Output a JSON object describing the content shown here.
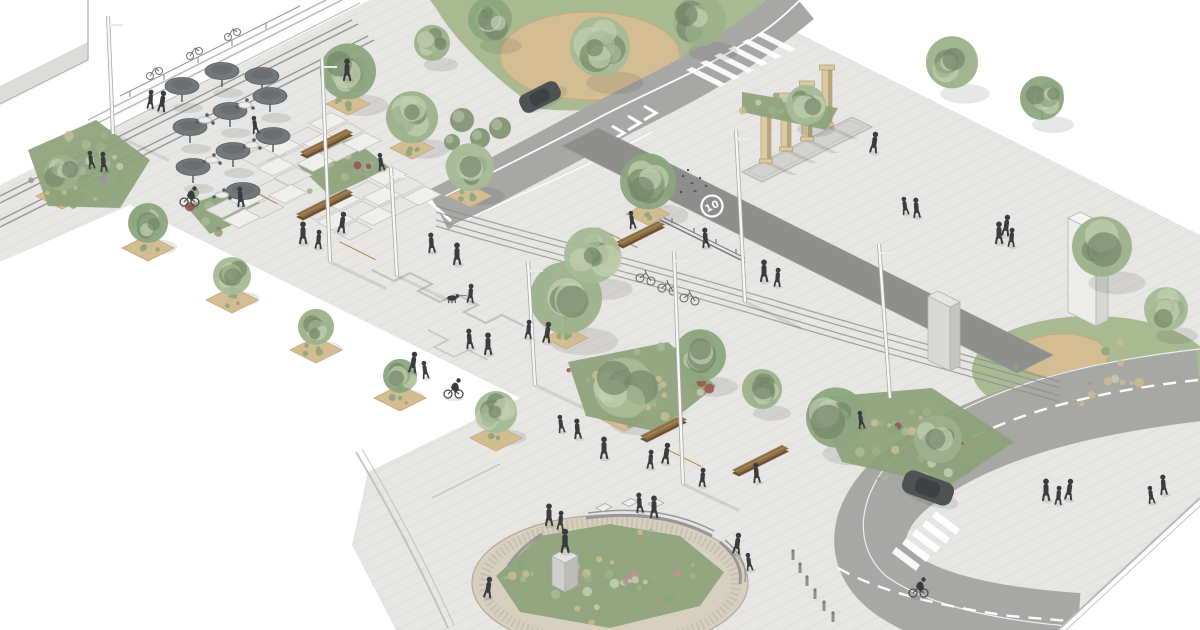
{
  "scene": {
    "road_marking": {
      "label": "10"
    },
    "colors": {
      "bg": "#ffffff",
      "plaza": "#e7e6e4",
      "paver_line": "#d6d6d4",
      "road": "#a7a7a5",
      "road_dark": "#8e8e8c",
      "band_edge": "#9a9a98",
      "marking": "#ffffff",
      "lawn": "#a9ba92",
      "sand": "#d4bd93",
      "sand_edge": "#c4ab7e",
      "cobble": "#d7d0c0",
      "cobble_edge": "#b2ab99",
      "cobble_dot": "#bdb7a7",
      "bed_base": "#8da27a",
      "wood": "#8f6f46",
      "wood_light": "#aa8957",
      "wood_dark": "#6c5234",
      "umbrella": "#75787a",
      "umbrella_dark": "#5c5f61",
      "people": "#3a3c3d",
      "trunk": "#8b8274",
      "pole": "#f7f7f5",
      "pole_edge": "#a9a9a7",
      "column": "#d9caa0",
      "column_dark": "#b7a67d",
      "monolith": "#ededeb",
      "monolith_side": "#d5d5d3",
      "concrete": "#d8d8d6",
      "concrete_side": "#c3c3c1",
      "car": "#4e5253",
      "car_roof": "#3b3f40",
      "rail": "#8d8d8b",
      "line_gray": "#b9b9b7",
      "bush": "#7d9070",
      "red_accent": "#98524d",
      "pink_accent": "#c38f92",
      "lavender": "#9a90b4",
      "tan_grass": "#c8bd92",
      "tree_greens": [
        "#9cb18b",
        "#8ca57e",
        "#a6ba96"
      ],
      "tree_light": "#c3cfb0",
      "tree_dark": "#75886a",
      "shadow": "rgba(60,60,58,0.12)"
    },
    "trees": [
      [
        62,
        190,
        18,
        0
      ],
      [
        148,
        242,
        20,
        1
      ],
      [
        232,
        294,
        19,
        2
      ],
      [
        316,
        344,
        18,
        0
      ],
      [
        400,
        392,
        17,
        1
      ],
      [
        496,
        432,
        21,
        2
      ],
      [
        348,
        98,
        28,
        1
      ],
      [
        412,
        142,
        26,
        0
      ],
      [
        470,
        190,
        24,
        2
      ],
      [
        432,
        60,
        18,
        0
      ],
      [
        566,
        332,
        36,
        0
      ],
      [
        592,
        282,
        28,
        2
      ],
      [
        648,
        208,
        28,
        1
      ],
      [
        600,
        75,
        30,
        2
      ],
      [
        700,
        45,
        26,
        0
      ],
      [
        490,
        40,
        22,
        1
      ],
      [
        952,
        87,
        26,
        0
      ],
      [
        1042,
        119,
        22,
        1
      ],
      [
        806,
        124,
        20,
        2
      ],
      [
        1102,
        275,
        30,
        0
      ],
      [
        1166,
        330,
        22,
        2
      ],
      [
        836,
        446,
        30,
        1
      ],
      [
        938,
        462,
        24,
        0
      ],
      [
        624,
        416,
        30,
        2
      ],
      [
        700,
        380,
        26,
        1
      ],
      [
        762,
        408,
        20,
        0
      ]
    ],
    "tree_pits": [
      [
        348,
        104,
        44
      ],
      [
        412,
        148,
        44
      ],
      [
        470,
        196,
        44
      ],
      [
        566,
        338,
        44
      ],
      [
        648,
        214,
        44
      ],
      [
        624,
        420,
        44
      ],
      [
        62,
        196,
        52
      ],
      [
        148,
        248,
        52
      ],
      [
        232,
        300,
        52
      ],
      [
        316,
        350,
        52
      ],
      [
        400,
        398,
        52
      ],
      [
        496,
        438,
        52
      ]
    ],
    "people": [
      [
        92,
        168
      ],
      [
        104,
        171
      ],
      [
        347,
        80
      ],
      [
        150,
        108
      ],
      [
        161,
        111
      ],
      [
        256,
        133
      ],
      [
        241,
        206
      ],
      [
        303,
        243
      ],
      [
        318,
        248
      ],
      [
        341,
        232
      ],
      [
        382,
        170
      ],
      [
        432,
        252
      ],
      [
        457,
        264
      ],
      [
        470,
        302
      ],
      [
        412,
        372
      ],
      [
        426,
        378
      ],
      [
        470,
        348
      ],
      [
        488,
        354
      ],
      [
        528,
        338
      ],
      [
        546,
        342
      ],
      [
        562,
        432
      ],
      [
        578,
        438
      ],
      [
        604,
        458
      ],
      [
        650,
        468
      ],
      [
        665,
        463
      ],
      [
        633,
        228
      ],
      [
        706,
        247
      ],
      [
        764,
        281
      ],
      [
        777,
        286
      ],
      [
        873,
        152
      ],
      [
        906,
        214
      ],
      [
        917,
        217
      ],
      [
        999,
        243
      ],
      [
        1011,
        246
      ],
      [
        1005,
        235
      ],
      [
        862,
        428
      ],
      [
        757,
        482
      ],
      [
        1046,
        500
      ],
      [
        1058,
        504
      ],
      [
        1068,
        499
      ],
      [
        1152,
        503
      ],
      [
        1164,
        494
      ],
      [
        549,
        525
      ],
      [
        560,
        529
      ],
      [
        736,
        553
      ],
      [
        750,
        570
      ],
      [
        640,
        512
      ],
      [
        654,
        517
      ],
      [
        702,
        486
      ],
      [
        487,
        597
      ]
    ],
    "cyclists": [
      [
        184,
        206
      ],
      [
        448,
        398
      ],
      [
        913,
        597
      ]
    ],
    "parked_bikes": [
      [
        640,
        278
      ],
      [
        662,
        288
      ],
      [
        684,
        298
      ]
    ],
    "umbrellas": [
      [
        182,
        102
      ],
      [
        222,
        87
      ],
      [
        262,
        92
      ],
      [
        190,
        143
      ],
      [
        230,
        127
      ],
      [
        270,
        112
      ],
      [
        193,
        183
      ],
      [
        233,
        167
      ],
      [
        273,
        152
      ],
      [
        243,
        207
      ]
    ],
    "cafe_tables": [
      [
        205,
        120
      ],
      [
        245,
        105
      ],
      [
        212,
        160
      ],
      [
        252,
        145
      ],
      [
        222,
        195
      ]
    ],
    "poles": [
      [
        330,
        262,
        322,
        58
      ],
      [
        535,
        385,
        528,
        262
      ],
      [
        683,
        484,
        674,
        252
      ],
      [
        890,
        398,
        879,
        244
      ],
      [
        745,
        302,
        736,
        130
      ],
      [
        113,
        134,
        108,
        16
      ],
      [
        397,
        276,
        391,
        168
      ]
    ],
    "benches": [
      [
        300,
        152,
        46,
        0
      ],
      [
        238,
        184,
        36,
        1
      ],
      [
        296,
        214,
        50,
        0
      ],
      [
        336,
        240,
        36,
        1
      ],
      [
        594,
        226,
        40,
        1
      ],
      [
        616,
        242,
        42,
        0
      ],
      [
        640,
        436,
        40,
        0
      ],
      [
        662,
        447,
        36,
        1
      ],
      [
        732,
        470,
        50,
        0
      ]
    ],
    "bollards": [
      [
        793,
        560
      ],
      [
        800,
        573
      ],
      [
        807,
        586
      ],
      [
        815,
        599
      ],
      [
        824,
        611
      ],
      [
        833,
        622
      ]
    ],
    "columns": [
      [
        766,
        162,
        48
      ],
      [
        786,
        150,
        52
      ],
      [
        807,
        140,
        54
      ],
      [
        827,
        126,
        56
      ]
    ],
    "pigeons": [
      [
        648,
        172
      ],
      [
        656,
        178
      ],
      [
        666,
        174
      ],
      [
        674,
        182
      ],
      [
        683,
        176
      ],
      [
        692,
        184
      ],
      [
        700,
        178
      ],
      [
        660,
        190
      ],
      [
        670,
        194
      ],
      [
        681,
        192
      ],
      [
        652,
        185
      ],
      [
        695,
        192
      ],
      [
        706,
        186
      ],
      [
        688,
        170
      ]
    ],
    "bushes": [
      [
        462,
        120,
        12
      ],
      [
        480,
        138,
        10
      ],
      [
        500,
        128,
        11
      ],
      [
        452,
        142,
        8
      ]
    ],
    "planting_beds": [
      {
        "points": [
          [
            28,
            150
          ],
          [
            96,
            120
          ],
          [
            150,
            160
          ],
          [
            120,
            208
          ],
          [
            48,
            206
          ]
        ],
        "accent": "lavender",
        "tufts": 26,
        "base": true
      },
      {
        "points": [
          [
            292,
            160
          ],
          [
            352,
            138
          ],
          [
            390,
            168
          ],
          [
            330,
            196
          ]
        ],
        "accent": "red",
        "tufts": 18,
        "base": true
      },
      {
        "points": [
          [
            186,
            206
          ],
          [
            240,
            186
          ],
          [
            268,
            210
          ],
          [
            210,
            234
          ]
        ],
        "accent": "red",
        "tufts": 14,
        "base": true
      },
      {
        "points": [
          [
            568,
            362
          ],
          [
            668,
            342
          ],
          [
            716,
            386
          ],
          [
            658,
            432
          ],
          [
            586,
            416
          ]
        ],
        "accent": "red",
        "tufts": 30,
        "base": true
      },
      {
        "points": [
          [
            812,
            398
          ],
          [
            932,
            388
          ],
          [
            1014,
            442
          ],
          [
            948,
            486
          ],
          [
            842,
            462
          ]
        ],
        "accent": "red",
        "tufts": 34,
        "base": true
      },
      {
        "points": [
          [
            742,
            92
          ],
          [
            838,
            108
          ],
          [
            826,
            130
          ],
          [
            742,
            112
          ]
        ],
        "accent": "none",
        "tufts": 8,
        "base": true
      },
      {
        "points": [
          [
            996,
            368
          ],
          [
            1048,
            336
          ],
          [
            1124,
            332
          ],
          [
            1176,
            360
          ],
          [
            1152,
            398
          ],
          [
            1056,
            408
          ]
        ],
        "accent": "none",
        "tufts": 14,
        "base": false
      },
      {
        "points": [
          [
            496,
            576
          ],
          [
            540,
            536
          ],
          [
            610,
            524
          ],
          [
            680,
            536
          ],
          [
            724,
            572
          ],
          [
            700,
            606
          ],
          [
            610,
            628
          ],
          [
            520,
            612
          ]
        ],
        "accent": "pink",
        "tufts": 48,
        "base": true
      }
    ],
    "terraces": [
      {
        "x": 240,
        "y": 158,
        "rows": 3,
        "cols": 4
      },
      {
        "x": 206,
        "y": 210,
        "rows": 2,
        "cols": 3
      },
      {
        "x": 300,
        "y": 212,
        "rows": 3,
        "cols": 4
      }
    ],
    "dog": {
      "x": 452,
      "y": 298,
      "leash_to": [
        468,
        296
      ]
    }
  }
}
